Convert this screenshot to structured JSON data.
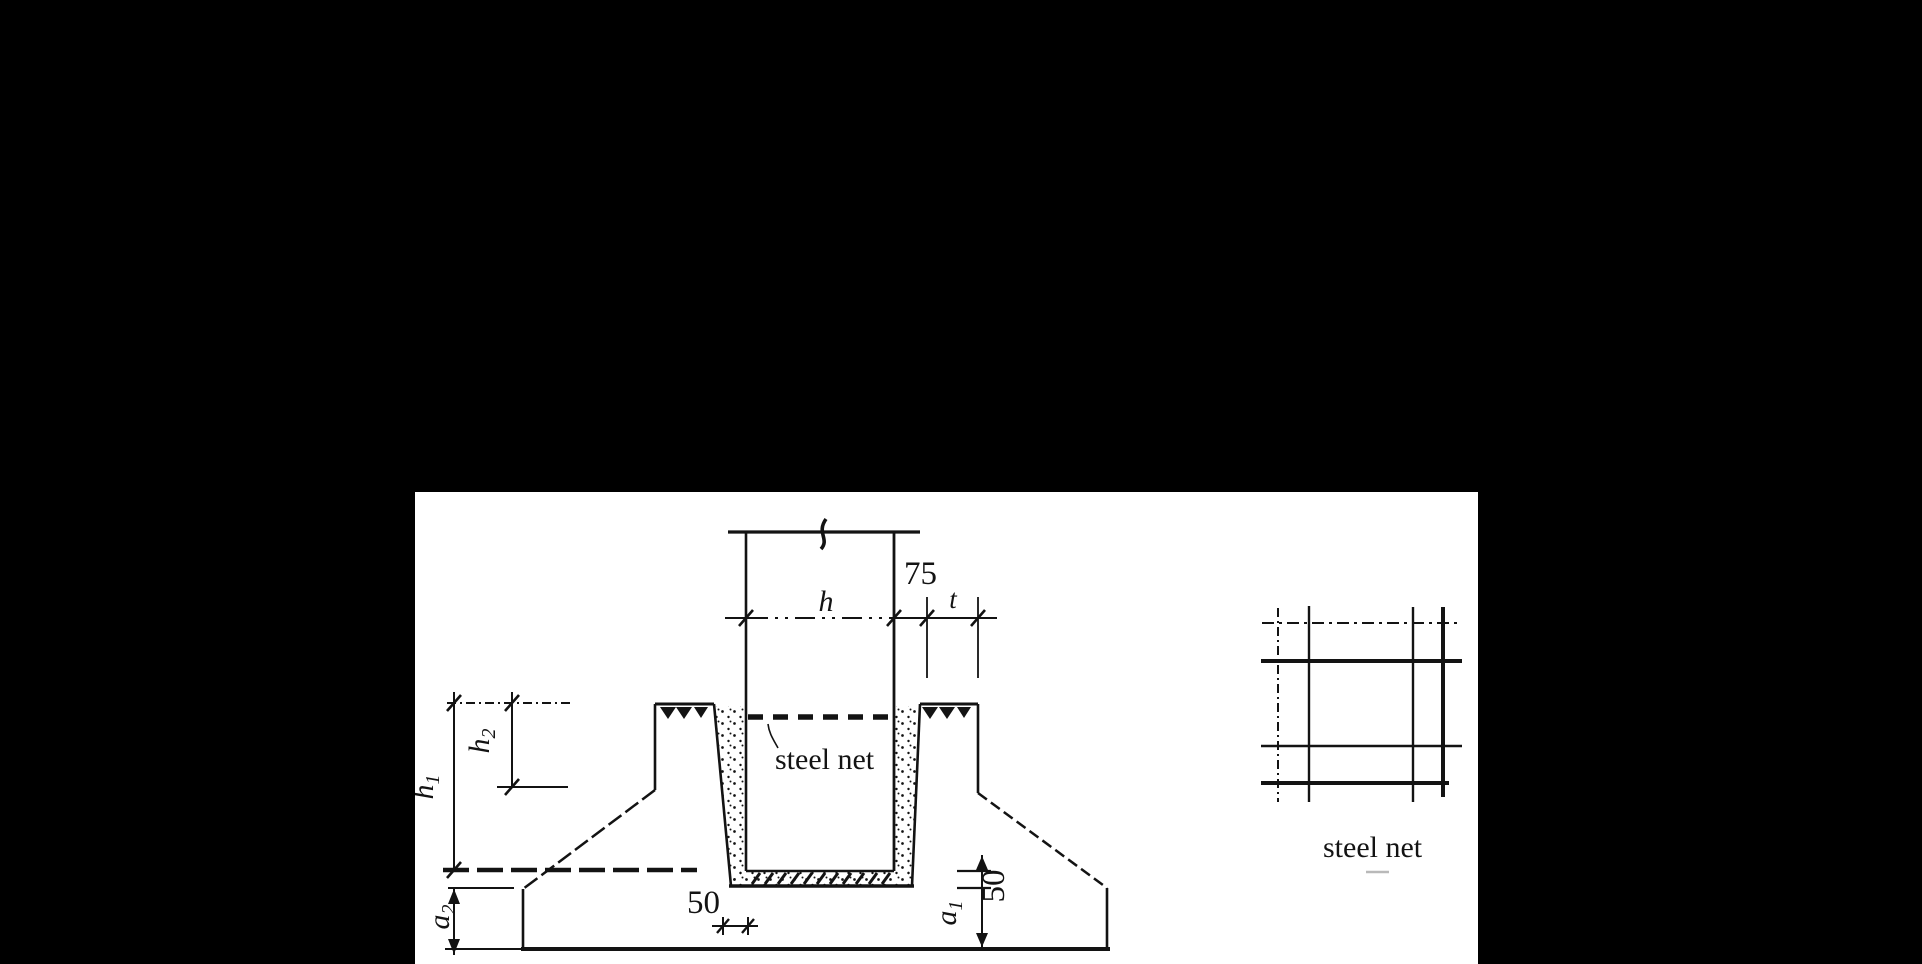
{
  "colors": {
    "background": "#000000",
    "panel": "#ffffff",
    "ink": "#131313",
    "smudge": "#b9b9b9"
  },
  "section_view": {
    "dim_75": "75",
    "dim_h": "h",
    "dim_t": "t",
    "dim_h1": {
      "base": "h",
      "sub": "1"
    },
    "dim_h2": {
      "base": "h",
      "sub": "2"
    },
    "dim_a1": {
      "base": "a",
      "sub": "1"
    },
    "dim_a2": {
      "base": "a",
      "sub": "2"
    },
    "dim_50_wall": "50",
    "dim_50_bottom": "50",
    "steel_net_label": "steel net"
  },
  "plan_view": {
    "steel_net_label": "steel net"
  }
}
